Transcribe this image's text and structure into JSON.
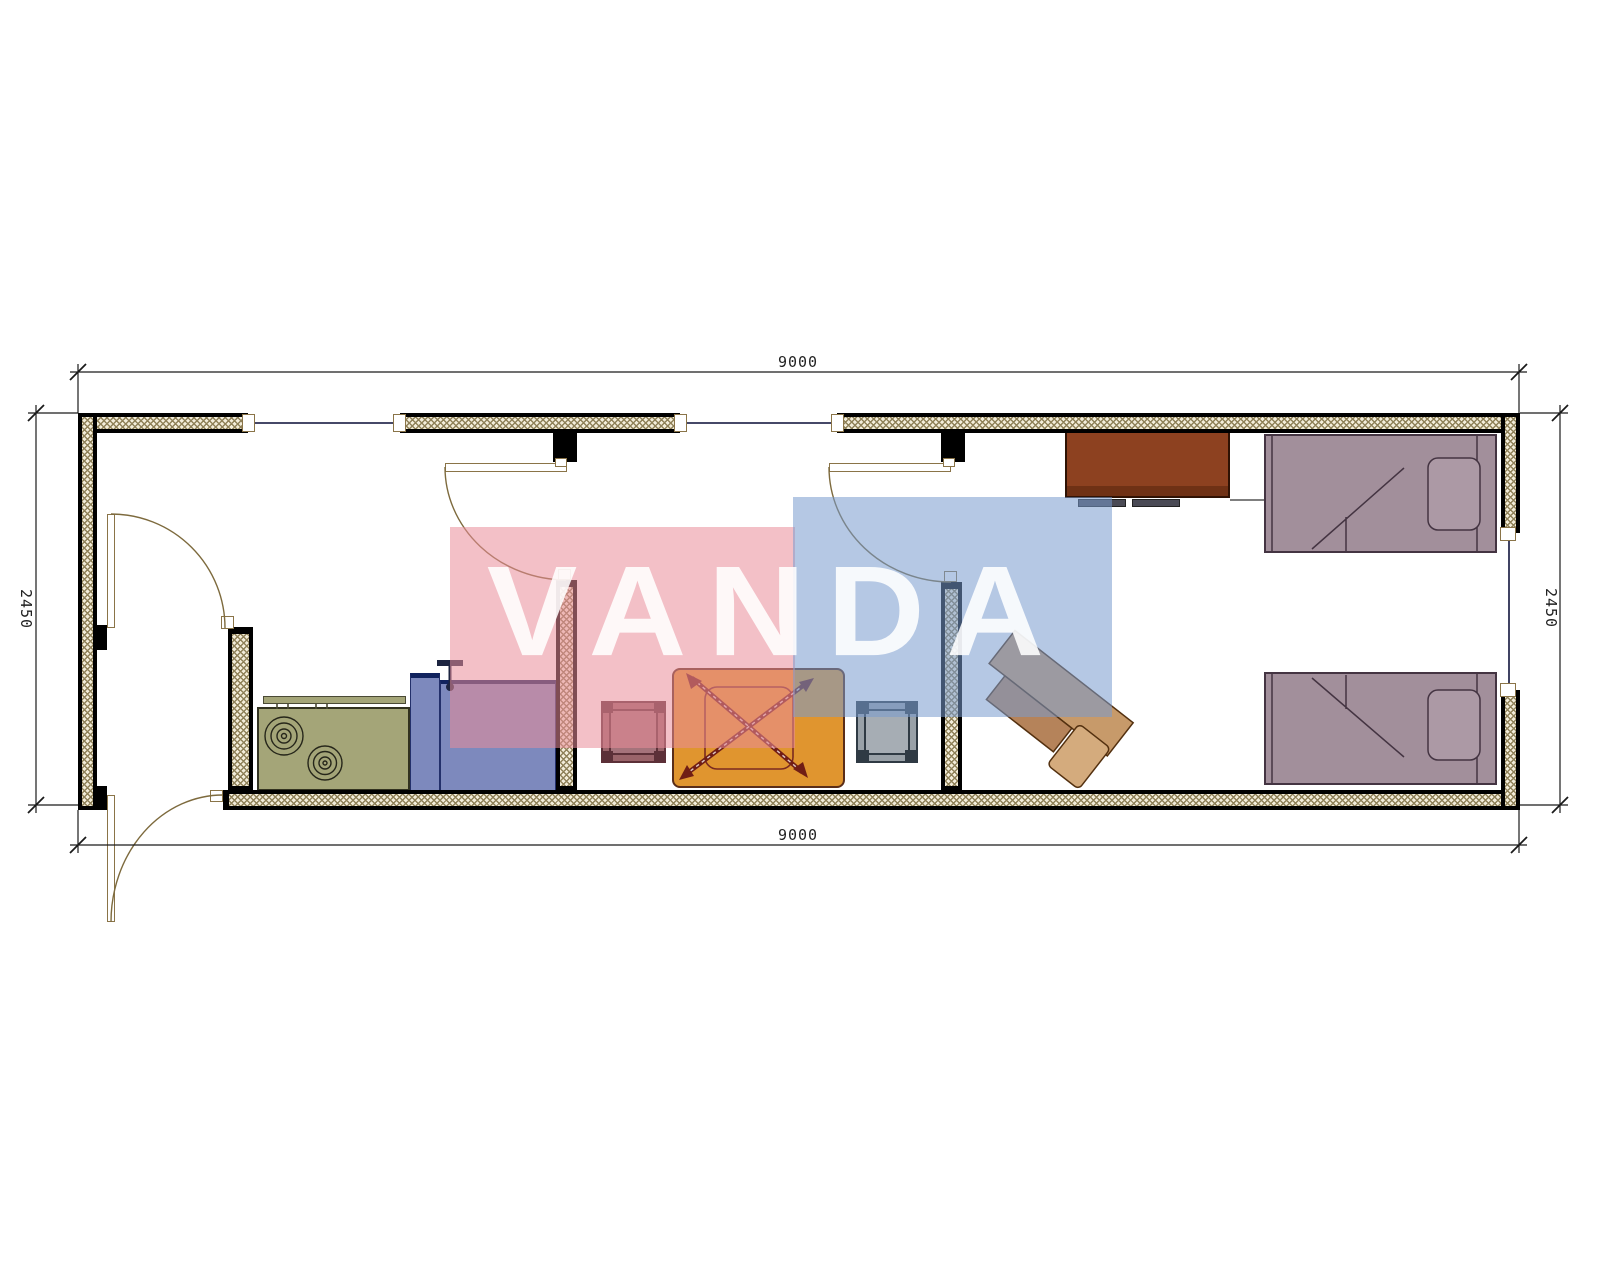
{
  "page": {
    "type": "architectural floor plan"
  },
  "watermark": {
    "text": "VANDA"
  },
  "dimensions": {
    "top": "9000",
    "bottom": "9000",
    "left": "2450",
    "right": "2450"
  },
  "furniture": {
    "stove": {
      "color": "#a4a578"
    },
    "kitchen_counter": {
      "color": "#7d89bd"
    },
    "faucet": {
      "color": "#1c2440"
    },
    "table_with_ceiling_fan": {
      "color": "#e0952f"
    },
    "stool_maroon": {
      "color": "#9a646a"
    },
    "stool_gray": {
      "color": "#99a1a8"
    },
    "desk": {
      "color": "#c79a6a"
    },
    "wardrobe": {
      "color": "#8d4120"
    },
    "bed_top": {
      "color": "#a28f9b"
    },
    "bed_bottom": {
      "color": "#a28f9b"
    }
  },
  "colors": {
    "wall_line": "#000000",
    "wall_hatch_bg": "#f3edda",
    "wall_hatch_line": "#8f8159",
    "watermark_pink": "rgba(233,140,153,0.55)",
    "watermark_blue": "rgba(120,155,205,0.55)",
    "door_line": "#7d6a3d",
    "window_line": "#2b2e52",
    "dimension_line": "#1a1a1a"
  }
}
